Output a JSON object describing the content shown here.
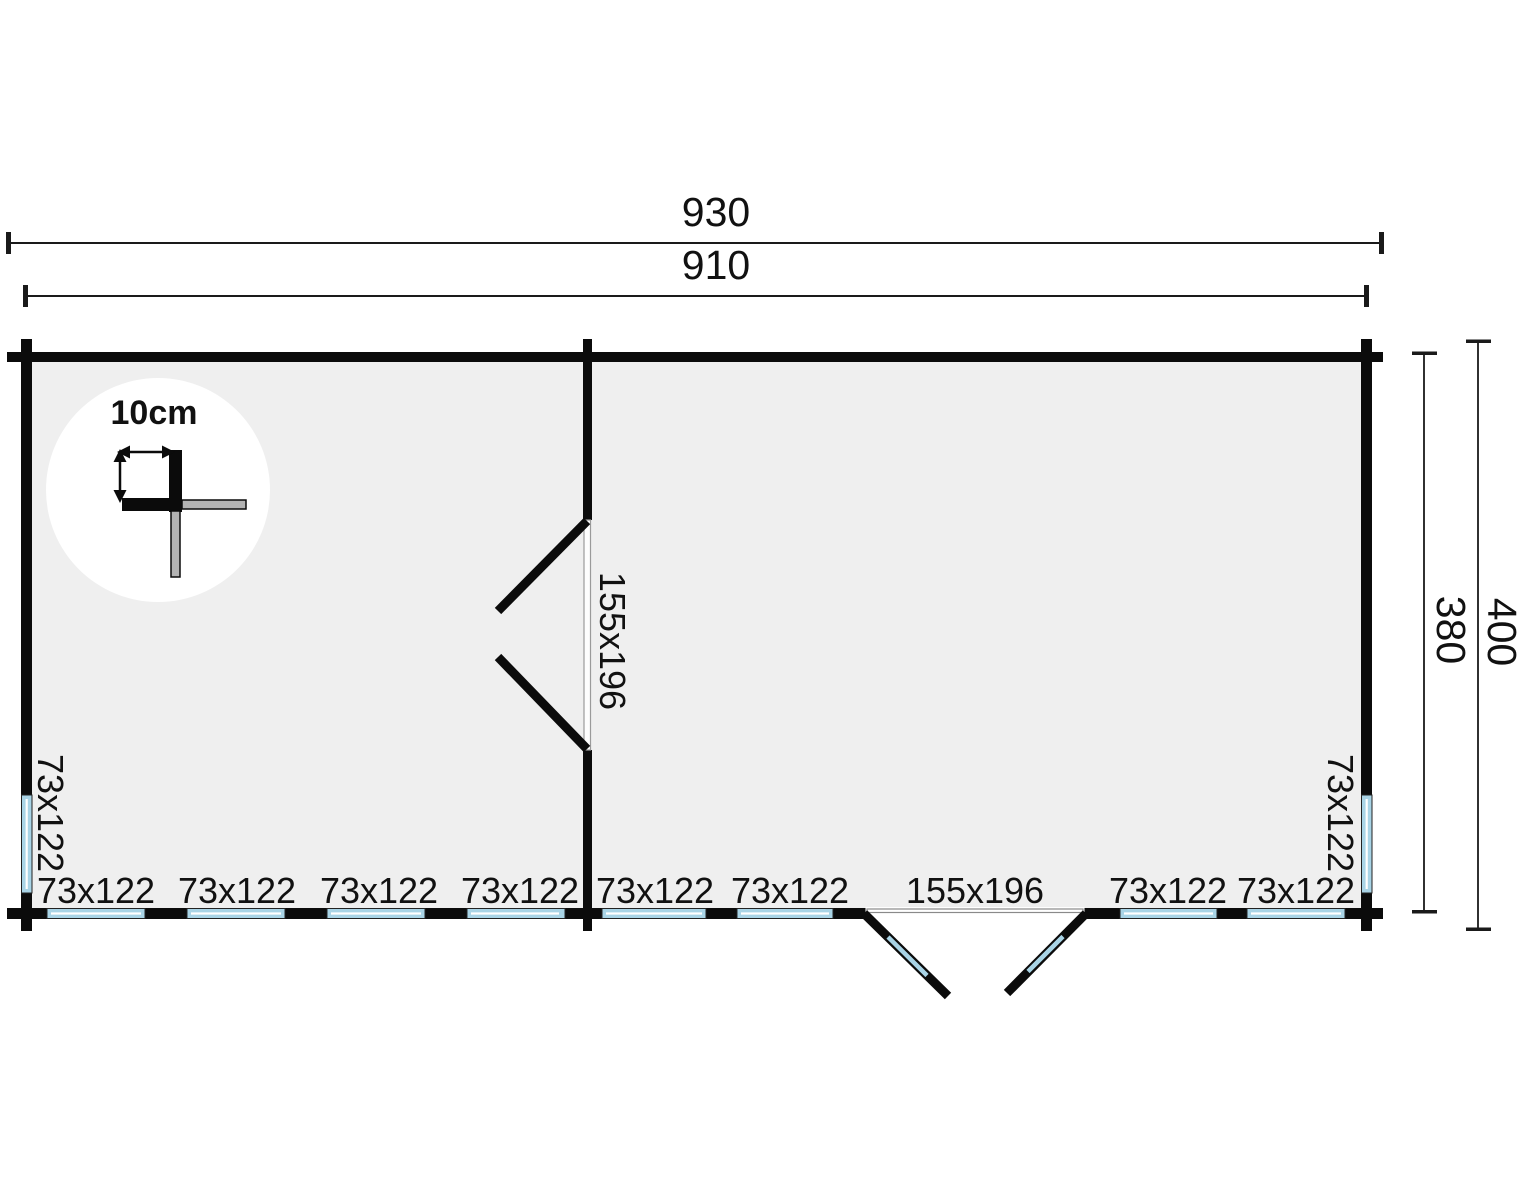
{
  "plan": {
    "dim_outer_width": "930",
    "dim_inner_width": "910",
    "dim_outer_depth": "400",
    "dim_inner_depth": "380",
    "detail_thickness": "10cm",
    "side_window_left": "73x122",
    "side_window_right": "73x122",
    "interior_door_label": "155x196",
    "bottom_labels": [
      "73x122",
      "73x122",
      "73x122",
      "73x122",
      "73x122",
      "73x122",
      "155x196",
      "73x122",
      "73x122"
    ],
    "colors": {
      "wall": "#0b0b0b",
      "floor": "#efefef",
      "glazing": "#a9d4e6",
      "log_gray": "#b3b3b3",
      "frame_gray": "#999999"
    }
  }
}
